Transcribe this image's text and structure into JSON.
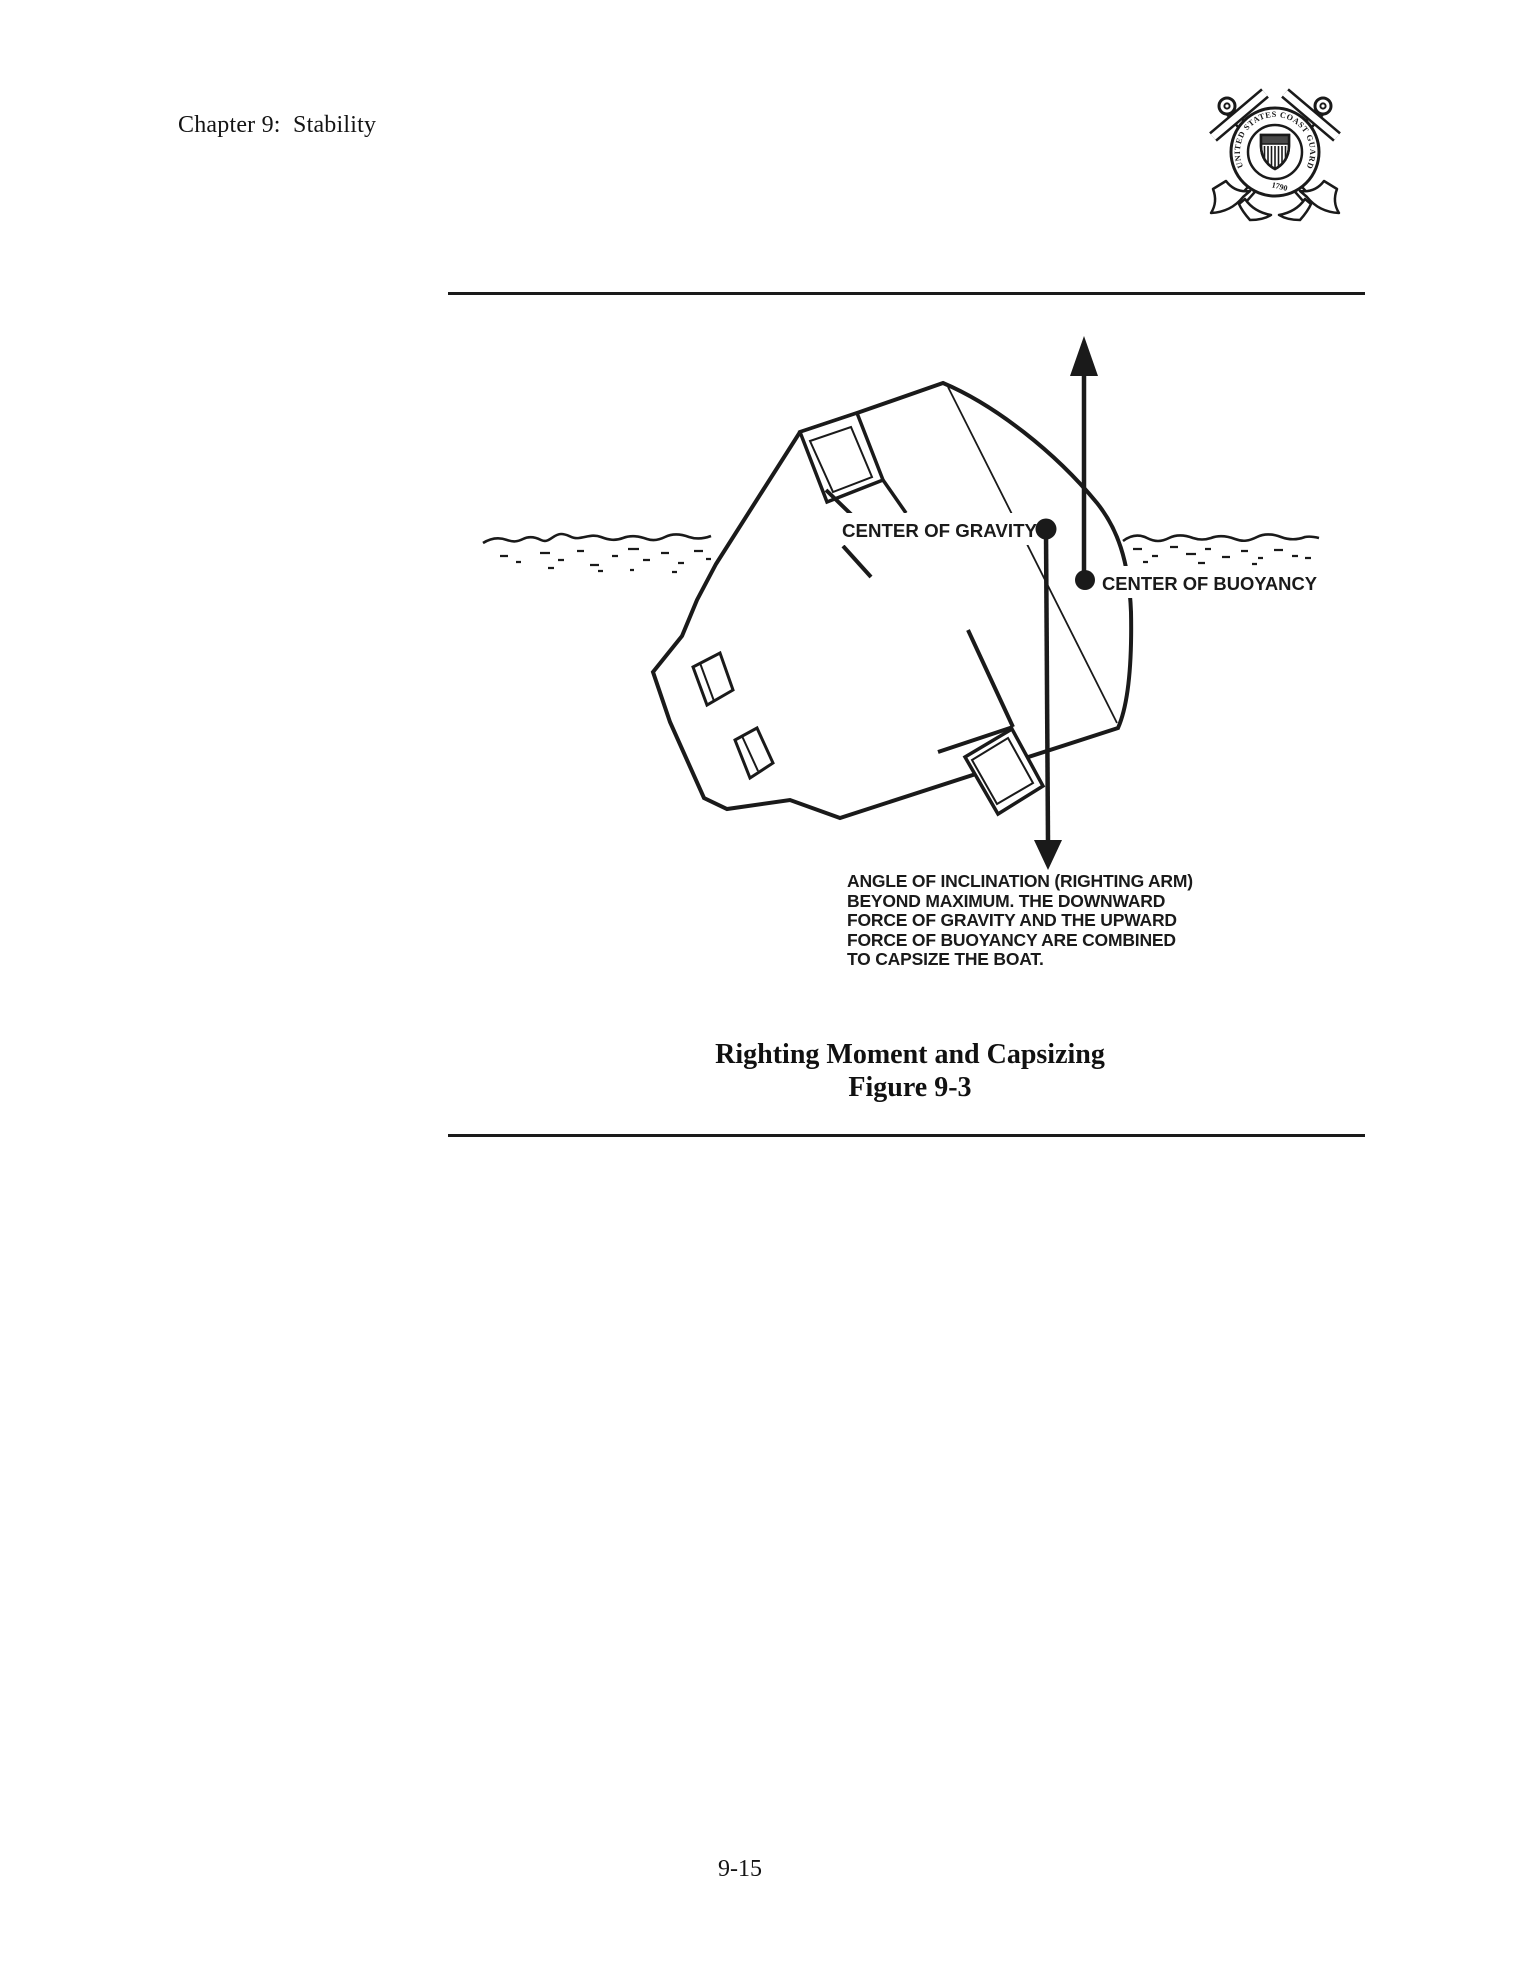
{
  "page": {
    "header": {
      "chapter_title": "Chapter 9:  Stability"
    },
    "emblem": {
      "ring_text": "UNITED STATES COAST GUARD",
      "year_text": "1790"
    },
    "figure": {
      "label_center_of_gravity": "CENTER OF GRAVITY",
      "label_center_of_buoyancy": "CENTER OF BUOYANCY",
      "annotation_lines": [
        "ANGLE OF INCLINATION (RIGHTING ARM)",
        "BEYOND MAXIMUM. THE DOWNWARD",
        "FORCE OF GRAVITY AND THE UPWARD",
        "FORCE OF BUOYANCY ARE COMBINED",
        "TO CAPSIZE THE BOAT."
      ],
      "caption_title": "Righting Moment and Capsizing",
      "caption_number": "Figure 9-3"
    },
    "footer": {
      "page_number": "9-15"
    },
    "colors": {
      "ink": "#1a1a1a",
      "paper": "#ffffff"
    }
  }
}
